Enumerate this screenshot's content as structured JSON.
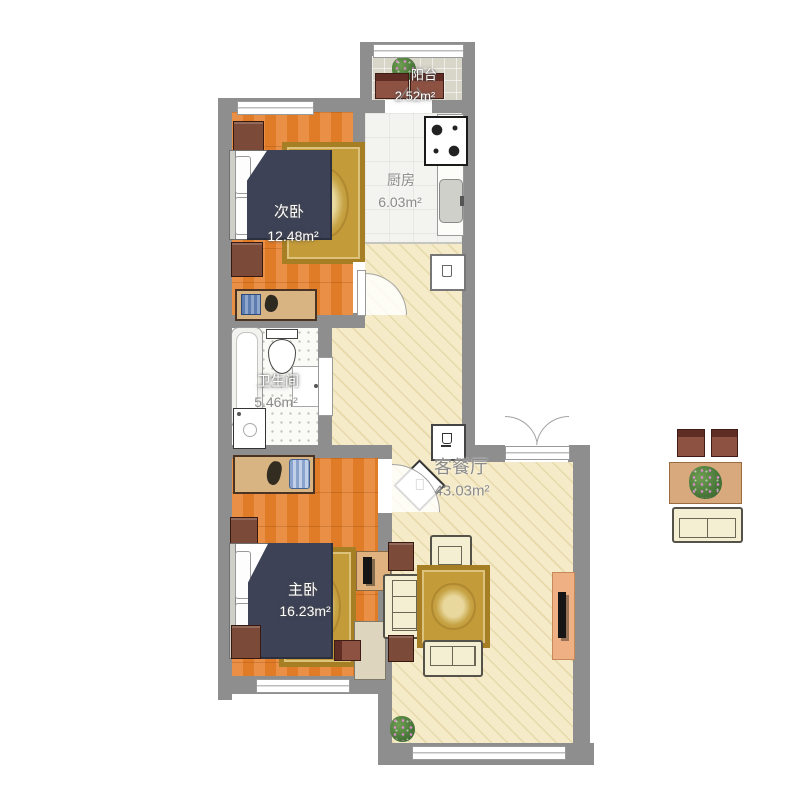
{
  "rooms": [
    {
      "id": "balcony",
      "name": "阳台",
      "area": "2.52m²"
    },
    {
      "id": "kitchen",
      "name": "厨房",
      "area": "6.03m²"
    },
    {
      "id": "second-bedroom",
      "name": "次卧",
      "area": "12.48m²"
    },
    {
      "id": "bathroom",
      "name": "卫生间",
      "area": "5.46m²"
    },
    {
      "id": "master-bedroom",
      "name": "主卧",
      "area": "16.23m²"
    },
    {
      "id": "living-dining",
      "name": "客餐厅",
      "area": "43.03m²"
    }
  ],
  "furniture_icons": [
    "double-bed",
    "nightstand",
    "desk",
    "wardrobe",
    "rug",
    "bathtub",
    "toilet",
    "washbasin-door",
    "washing-machine",
    "gas-stove",
    "kitchen-sink",
    "counter",
    "refrigerator",
    "water-dispenser",
    "rotated-cabinet",
    "armchair",
    "three-seat-sofa",
    "loveseat",
    "end-table",
    "tv-cabinet",
    "tv",
    "potted-plant",
    "dining-chair",
    "dining-table",
    "balcony-chair"
  ],
  "colors": {
    "wall": "#8e8e8e",
    "living-floor": "#f5ebc8",
    "living-floor-line": "#e7d9ab",
    "kitchen-floor": "#f3f3ef",
    "bathroom-floor": "#fafaf6",
    "balcony-floor": "#d8d5c9",
    "rug": "#c49b39",
    "rug-border": "#a67e24",
    "bed": "#3d4257",
    "sofa": "#f4efd3",
    "wood-furniture": "#7b4a38",
    "cabinet": "#d9b483",
    "tv-cabinet": "#efb183",
    "label-grey": "#8b8b8b"
  }
}
